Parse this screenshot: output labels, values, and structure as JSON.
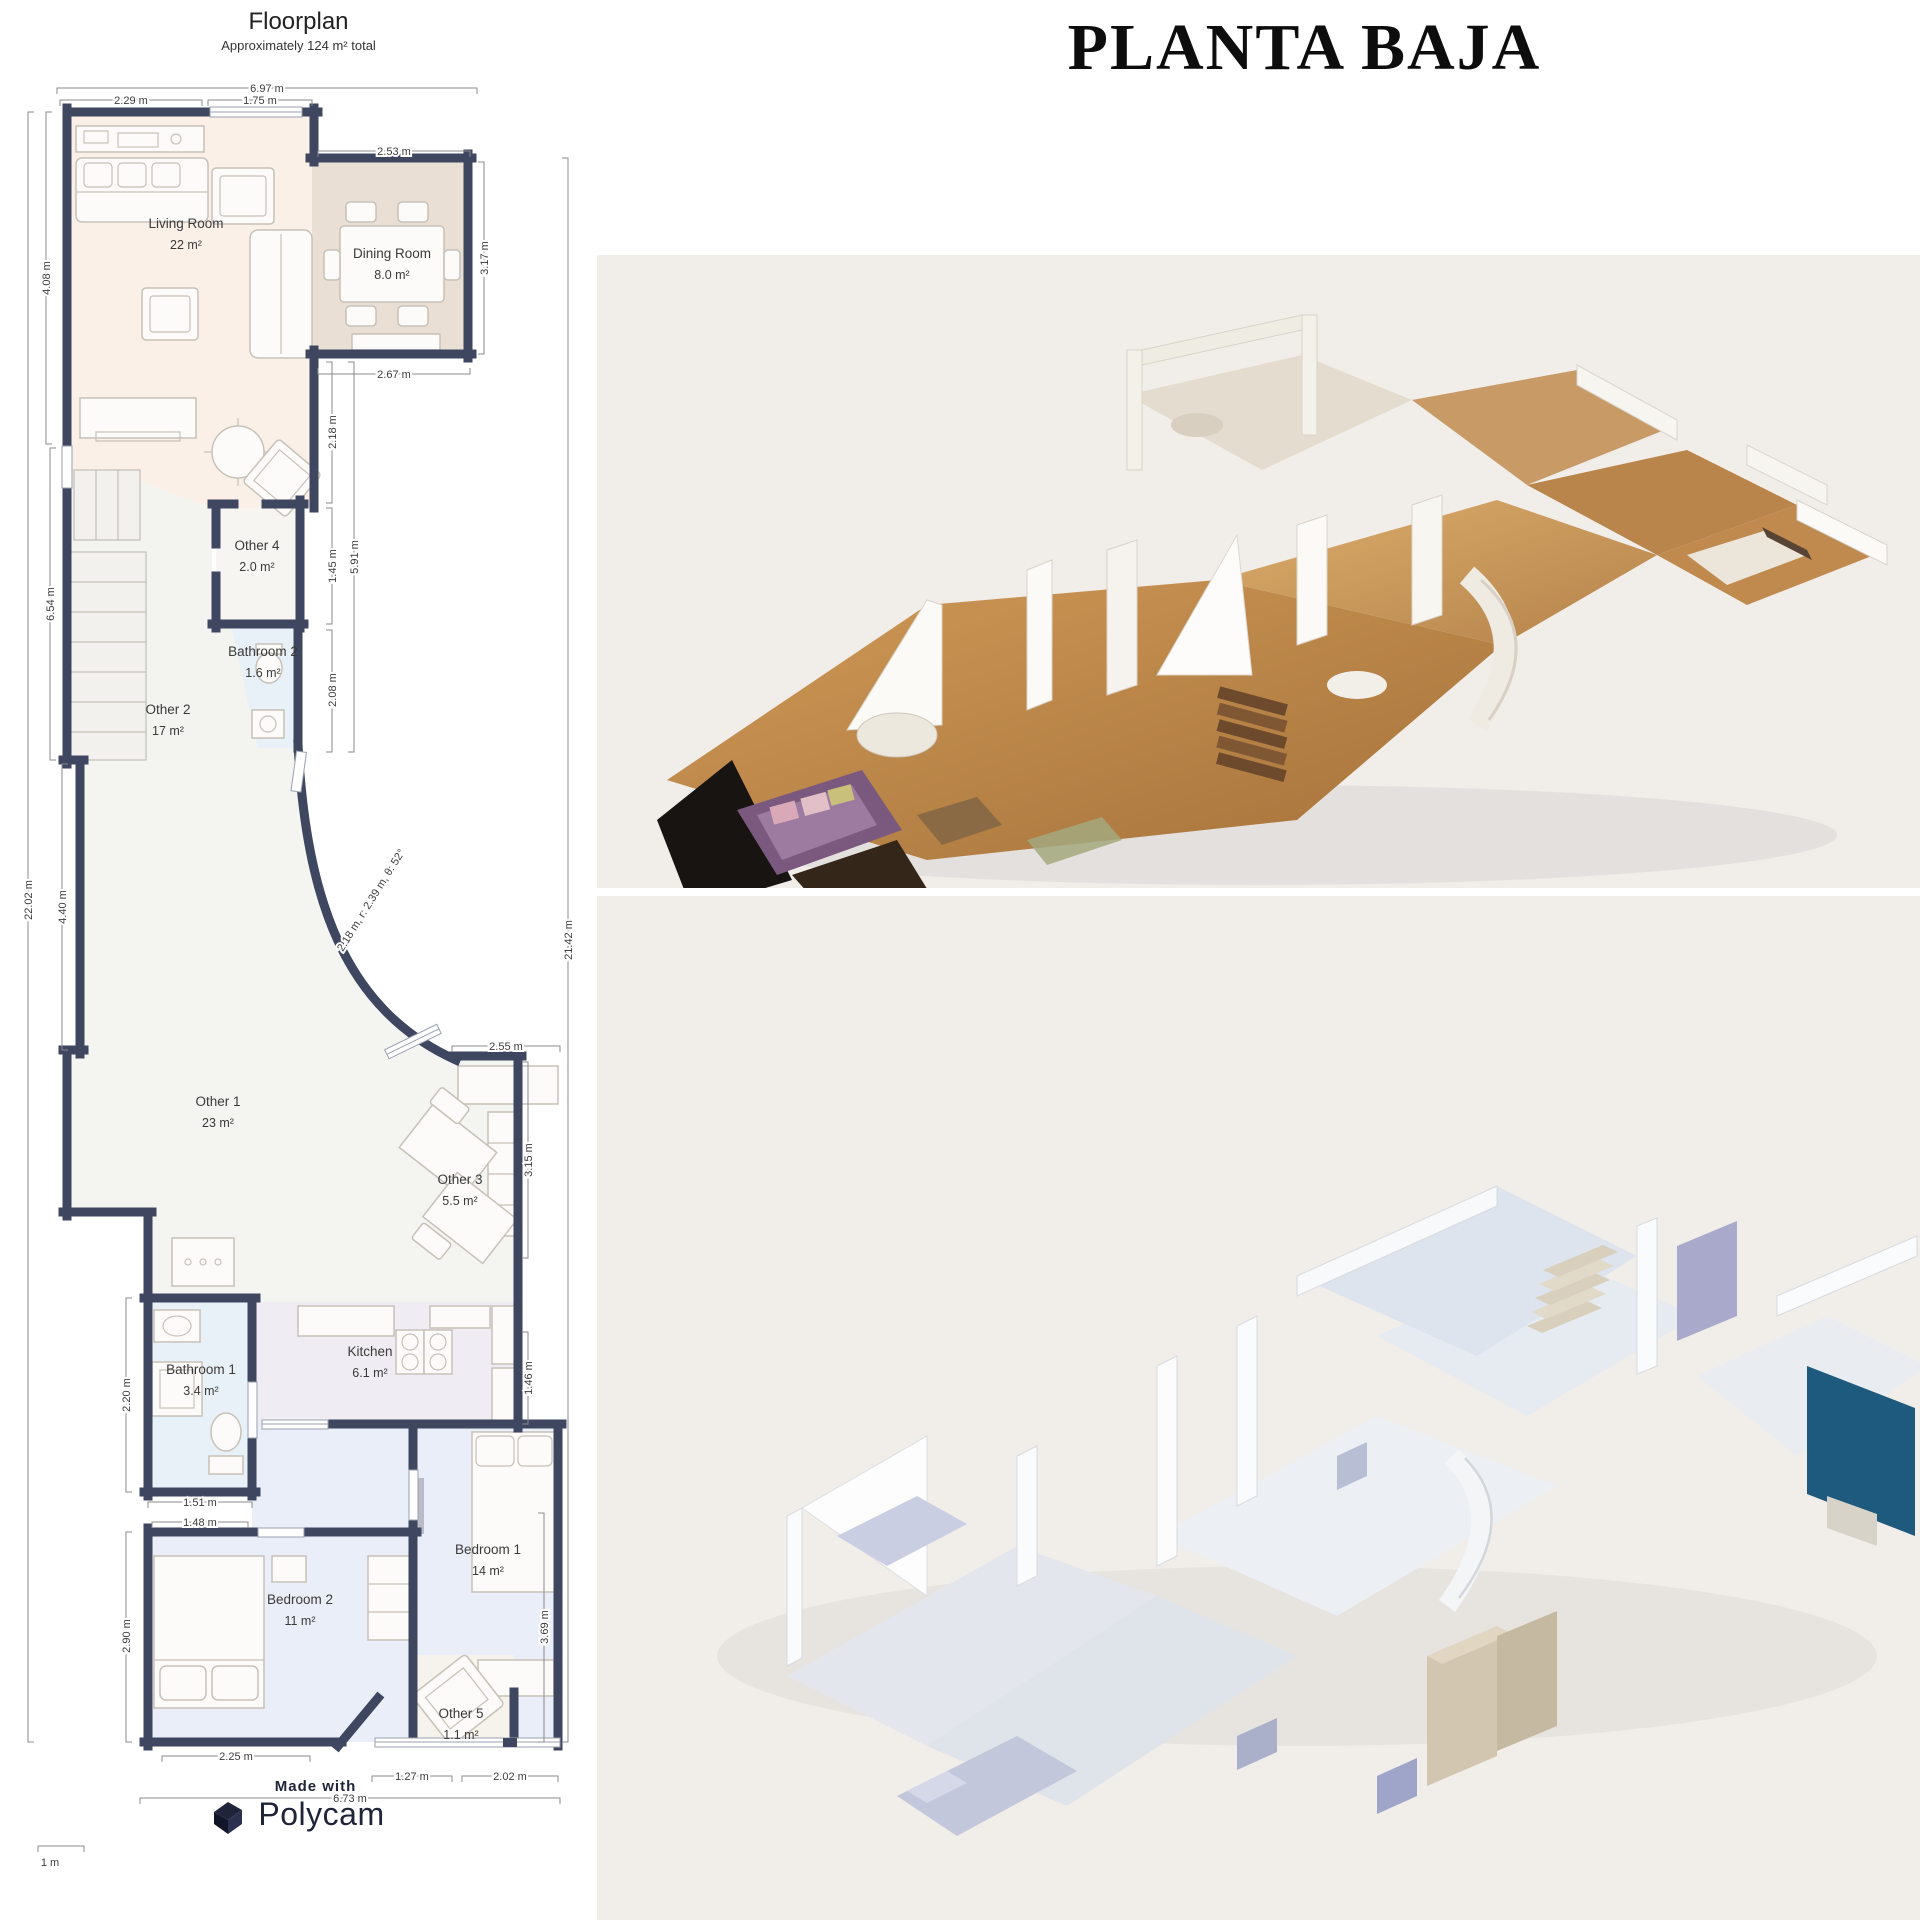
{
  "heading": {
    "title": "PLANTA BAJA"
  },
  "palette": {
    "wall": "#3e4660",
    "peach": "#fbf0e7",
    "tan": "#eadfd4",
    "roomgray": "#f3f3f0",
    "blue": "#e8f0f8",
    "lavender": "#efecf4",
    "bedblue": "#e9eef8",
    "cream": "#f6f3ec",
    "panel": "#f1ede9",
    "teal": "#1d5a7d",
    "wood": "#c08445",
    "ink": "#3c3c3c",
    "brand": "#20243a"
  },
  "floorplan": {
    "title": "Floorplan",
    "subtitle": "Approximately 124 m² total",
    "scale_label": "1 m",
    "rooms": [
      {
        "name": "Living Room",
        "area": "22 m²",
        "x": 186,
        "y": 228
      },
      {
        "name": "Dining Room",
        "area": "8.0 m²",
        "x": 392,
        "y": 258
      },
      {
        "name": "Other 2",
        "area": "17 m²",
        "x": 168,
        "y": 714
      },
      {
        "name": "Other 4",
        "area": "2.0 m²",
        "x": 257,
        "y": 550
      },
      {
        "name": "Bathroom 2",
        "area": "1.6 m²",
        "x": 263,
        "y": 656
      },
      {
        "name": "Other 1",
        "area": "23 m²",
        "x": 218,
        "y": 1106
      },
      {
        "name": "Other 3",
        "area": "5.5 m²",
        "x": 460,
        "y": 1184
      },
      {
        "name": "Kitchen",
        "area": "6.1 m²",
        "x": 370,
        "y": 1356
      },
      {
        "name": "Bathroom 1",
        "area": "3.4 m²",
        "x": 201,
        "y": 1374
      },
      {
        "name": "Bedroom 2",
        "area": "11 m²",
        "x": 300,
        "y": 1604
      },
      {
        "name": "Bedroom 1",
        "area": "14 m²",
        "x": 488,
        "y": 1554
      },
      {
        "name": "Other 5",
        "area": "1.1 m²",
        "x": 461,
        "y": 1718
      }
    ],
    "dimensions": [
      {
        "label": "6.97 m",
        "x": 267,
        "y": 92
      },
      {
        "label": "2.29 m",
        "x": 131,
        "y": 104
      },
      {
        "label": "1.75 m",
        "x": 260,
        "y": 104
      },
      {
        "label": "2.53 m",
        "x": 394,
        "y": 155
      },
      {
        "label": "2.67 m",
        "x": 394,
        "y": 378
      },
      {
        "label": "3.17 m",
        "x": 488,
        "y": 258,
        "rot": -90
      },
      {
        "label": "4.08 m",
        "x": 50,
        "y": 278,
        "rot": -90
      },
      {
        "label": "6.54 m",
        "x": 54,
        "y": 604,
        "rot": -90
      },
      {
        "label": "22.02 m",
        "x": 32,
        "y": 900,
        "rot": -90
      },
      {
        "label": "4.40 m",
        "x": 66,
        "y": 907,
        "rot": -90
      },
      {
        "label": "2.18 m",
        "x": 336,
        "y": 432,
        "rot": -90
      },
      {
        "label": "1.45 m",
        "x": 336,
        "y": 566,
        "rot": -90
      },
      {
        "label": "2.08 m",
        "x": 336,
        "y": 690,
        "rot": -90
      },
      {
        "label": "5.91 m",
        "x": 358,
        "y": 557,
        "rot": -90
      },
      {
        "label": "2.18 m, r: 2.39 m, θ: 52°",
        "x": 374,
        "y": 902,
        "rot": -58
      },
      {
        "label": "2.55 m",
        "x": 506,
        "y": 1050
      },
      {
        "label": "3.15 m",
        "x": 532,
        "y": 1160,
        "rot": -90
      },
      {
        "label": "1.46 m",
        "x": 532,
        "y": 1378,
        "rot": -90
      },
      {
        "label": "21.42 m",
        "x": 572,
        "y": 940,
        "rot": -90
      },
      {
        "label": "2.20 m",
        "x": 130,
        "y": 1395,
        "rot": -90
      },
      {
        "label": "1.51 m",
        "x": 200,
        "y": 1506
      },
      {
        "label": "1.48 m",
        "x": 200,
        "y": 1526
      },
      {
        "label": "2.90 m",
        "x": 130,
        "y": 1636,
        "rot": -90
      },
      {
        "label": "3.69 m",
        "x": 548,
        "y": 1627,
        "rot": -90
      },
      {
        "label": "2.25 m",
        "x": 236,
        "y": 1760
      },
      {
        "label": "1.27 m",
        "x": 412,
        "y": 1780
      },
      {
        "label": "2.02 m",
        "x": 510,
        "y": 1780
      },
      {
        "label": "6.73 m",
        "x": 350,
        "y": 1802
      }
    ]
  },
  "footer": {
    "made_with": "Made with",
    "brand": "Polycam"
  }
}
